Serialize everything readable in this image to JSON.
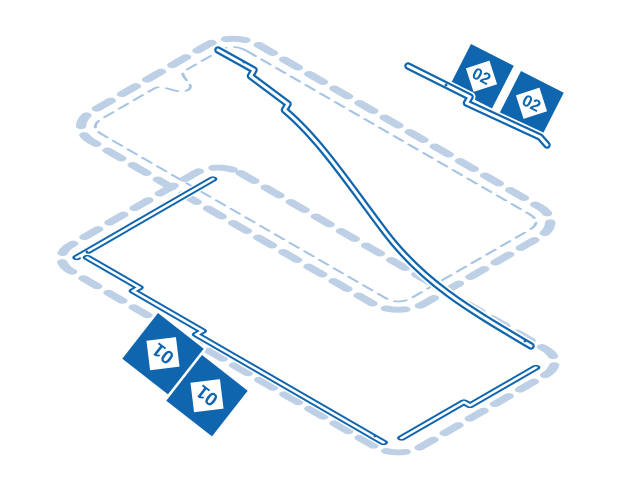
{
  "canvas": {
    "width": 640,
    "height": 480,
    "background": "#ffffff"
  },
  "palette": {
    "primary_blue": "#0f65ae",
    "dashed_outline_blue": "#bed0e6",
    "thin_dashed_blue": "#a6c4e2",
    "strip_fill": "#ffffff"
  },
  "tags": [
    {
      "part": "02",
      "label": "02"
    },
    {
      "part": "02",
      "label": "02"
    },
    {
      "part": "01",
      "label": "01"
    },
    {
      "part": "01",
      "label": "01"
    }
  ]
}
